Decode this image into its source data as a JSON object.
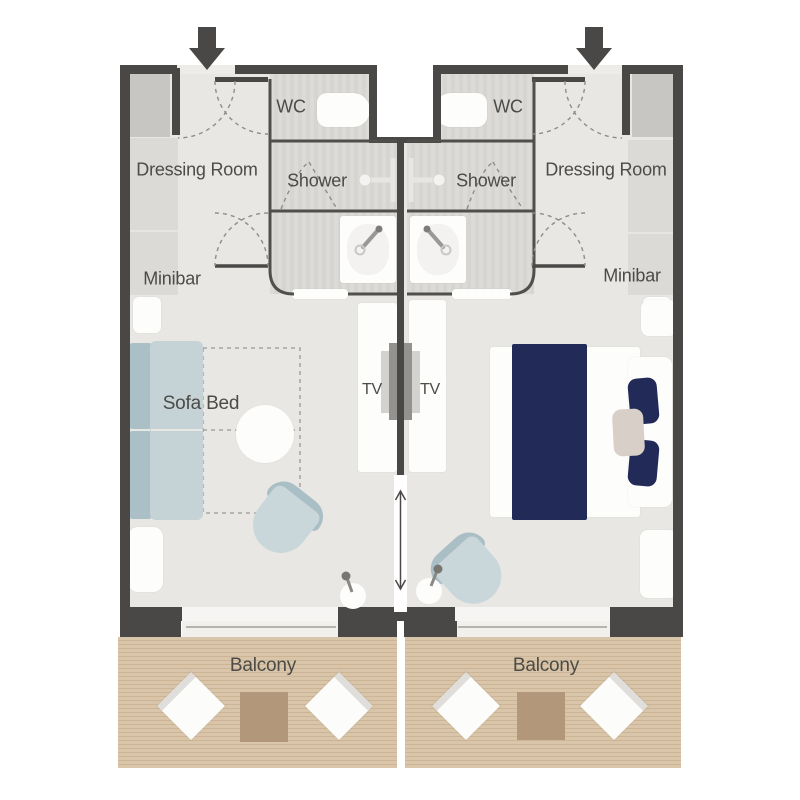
{
  "diagram_type": "cruise-cabin-floor-plan",
  "suites": {
    "left": {
      "dressing_room_label": "Dressing Room",
      "wc_label": "WC",
      "shower_label": "Shower",
      "minibar_label": "Minibar",
      "sofa_bed_label": "Sofa Bed",
      "tv_label": "TV",
      "balcony_label": "Balcony"
    },
    "right": {
      "dressing_room_label": "Dressing Room",
      "wc_label": "WC",
      "shower_label": "Shower",
      "minibar_label": "Minibar",
      "tv_label": "TV",
      "balcony_label": "Balcony"
    }
  },
  "colors": {
    "wall": "#494846",
    "floor": "#e9e7e4",
    "bathroom_floor": "#dbd9d6",
    "balcony_deck": "#d8c5aa",
    "balcony_table": "#b2977a",
    "sofa": "#c5d2d6",
    "chair": "#c9d7da",
    "bed_textile_navy": "#222b57",
    "accent_beige": "#d8cfc8",
    "text": "#4c4b47"
  }
}
